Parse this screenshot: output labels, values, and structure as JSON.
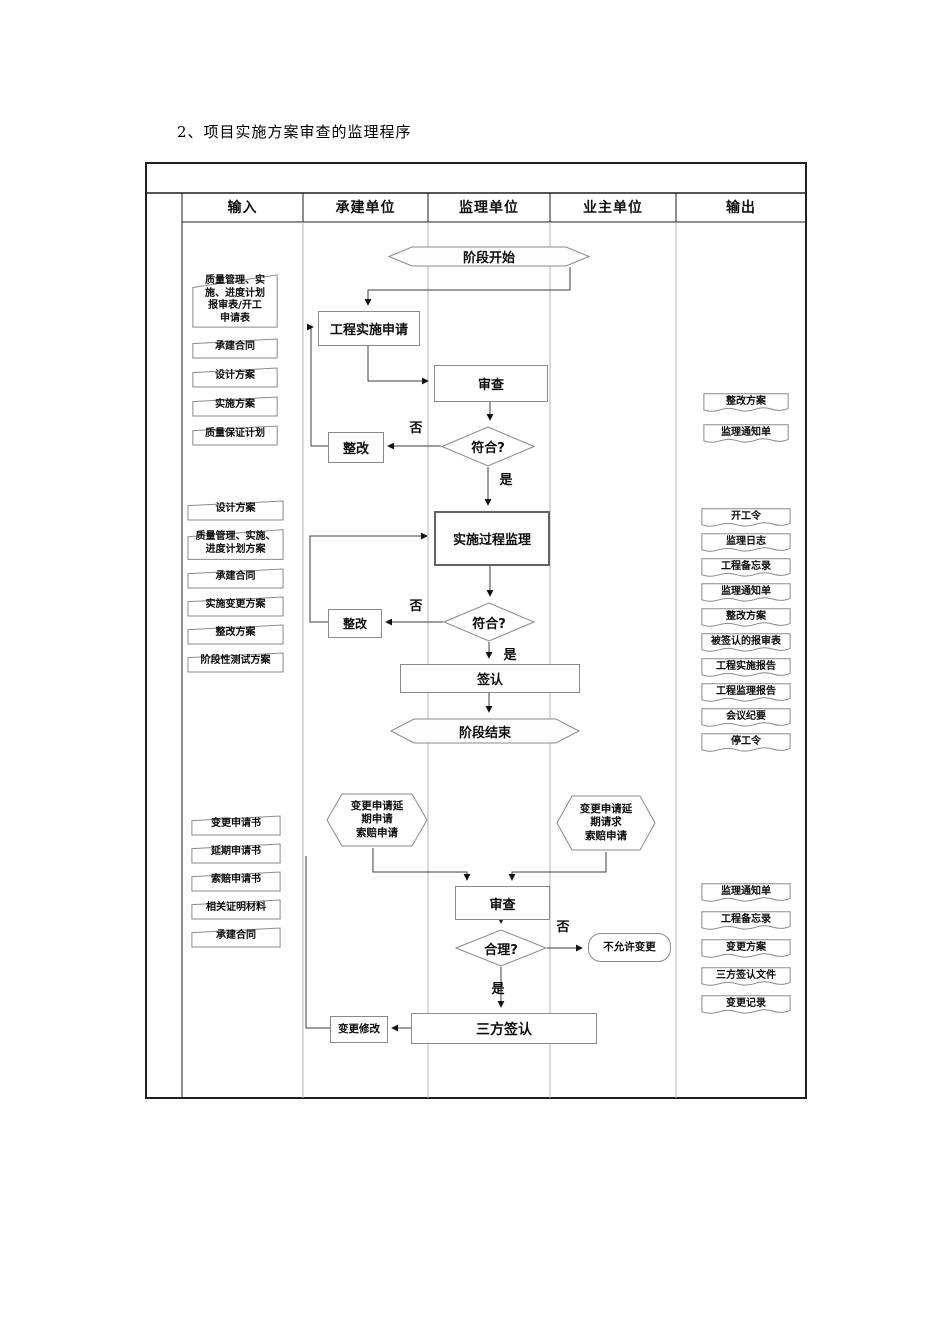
{
  "title": "2、项目实施方案审查的监理程序",
  "lanes": {
    "input": "输入",
    "contractor": "承建单位",
    "supervisor": "监理单位",
    "owner": "业主单位",
    "output": "输出"
  },
  "labels": {
    "yes": "是",
    "no": "否"
  },
  "flow": {
    "stage_start": "阶段开始",
    "impl_request": "工程实施申请",
    "review1": "审查",
    "check1": "符合?",
    "rework1": "整改",
    "process_supervision": "实施过程监理",
    "check2": "符合?",
    "rework2": "整改",
    "sign": "签认",
    "stage_end": "阶段结束",
    "contractor_change_request": "变更申请延\n期申请\n索赔申请",
    "owner_change_request": "变更申请延\n期请求\n索赔申请",
    "review2": "审查",
    "check3": "合理?",
    "reject_change": "不允许变更",
    "tri_party_sign": "三方签认",
    "change_modify": "变更修改"
  },
  "inputs": {
    "group1": [
      "质量管理、实\n施、进度计划\n报审表/开工\n申请表",
      "承建合同",
      "设计方案",
      "实施方案",
      "质量保证计划"
    ],
    "group2": [
      "设计方案",
      "质量管理、实施、\n进度计划方案",
      "承建合同",
      "实施变更方案",
      "整改方案",
      "阶段性测试方案"
    ],
    "group3": [
      "变更申请书",
      "延期申请书",
      "索赔申请书",
      "相关证明材料",
      "承建合同"
    ]
  },
  "outputs": {
    "group1": [
      "整改方案",
      "监理通知单"
    ],
    "group2": [
      "开工令",
      "监理日志",
      "工程备忘录",
      "监理通知单",
      "整改方案",
      "被签认的报审表",
      "工程实施报告",
      "工程监理报告",
      "会议纪要",
      "停工令"
    ],
    "group3": [
      "监理通知单",
      "工程备忘录",
      "变更方案",
      "三方签认文件",
      "变更记录"
    ]
  }
}
